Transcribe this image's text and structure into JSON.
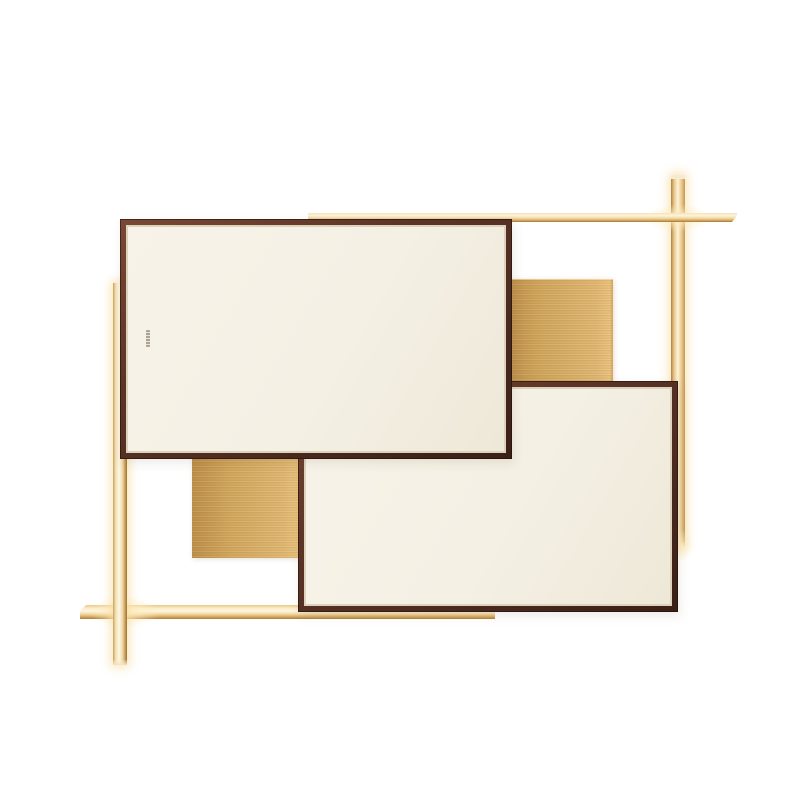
{
  "meta": {
    "type": "product-photograph",
    "subject": "Modernist wall-mounted LED lamp: two cream panels in dark espresso frames overlapping two brushed-brass squares, intersected by four glowing brass light bars on a white background",
    "canvas": {
      "width": 800,
      "height": 800
    }
  },
  "palette": {
    "background": "#ffffff",
    "frame-dark": "#3a2017",
    "frame-mid": "#5d3527",
    "frame-light": "#7a4836",
    "panel-face": "#f4f0e4",
    "panel-inner-line": "#ddd2bb",
    "brass-base": "#d0a55c",
    "brass-light": "#deb671",
    "brass-dark": "#bc8f49",
    "led-glow": "#fdf4da",
    "led-gold": "#eec87f",
    "led-deep": "#b08038",
    "glow-halo": "rgba(247,216,152,0.75)"
  },
  "scene": {
    "panels": [
      {
        "name": "panel-upper-left",
        "finish": "cream face, dark espresso frame",
        "rect": {
          "x": 120,
          "y": 219,
          "w": 392,
          "h": 240
        },
        "frame_px": 8,
        "z": "front"
      },
      {
        "name": "panel-lower-right",
        "finish": "cream face, dark espresso frame",
        "rect": {
          "x": 298,
          "y": 381,
          "w": 380,
          "h": 231
        },
        "frame_px": 8,
        "z": "behind upper panel"
      }
    ],
    "brass_squares": [
      {
        "name": "brass-square-upper-right",
        "finish": "brushed brass",
        "rect": {
          "x": 505,
          "y": 279,
          "w": 108,
          "h": 106
        },
        "z": "behind both panels"
      },
      {
        "name": "brass-square-lower-left",
        "finish": "brushed brass",
        "rect": {
          "x": 192,
          "y": 446,
          "w": 109,
          "h": 112
        },
        "z": "behind both panels"
      }
    ],
    "light_bars": [
      {
        "name": "led-bar-horizontal-top",
        "state": "lit",
        "rect": {
          "x": 308,
          "y": 213,
          "w": 429,
          "h": 9
        },
        "z": "in front of right bar, behind panels"
      },
      {
        "name": "led-bar-vertical-right",
        "state": "lit",
        "rect": {
          "x": 671,
          "y": 175,
          "w": 14,
          "h": 372
        },
        "z": "rearmost"
      },
      {
        "name": "led-bar-horizontal-bottom",
        "state": "lit",
        "rect": {
          "x": 80,
          "y": 605,
          "w": 415,
          "h": 14
        },
        "z": "behind left bar and panels"
      },
      {
        "name": "led-bar-vertical-left",
        "state": "lit",
        "rect": {
          "x": 113,
          "y": 283,
          "w": 14,
          "h": 382
        },
        "z": "in front of bottom bar, behind panels"
      }
    ],
    "brand_mark": {
      "name": "brand-mark",
      "legible": false,
      "rect": {
        "x": 146,
        "y": 330,
        "w": 4,
        "h": 17
      }
    }
  }
}
